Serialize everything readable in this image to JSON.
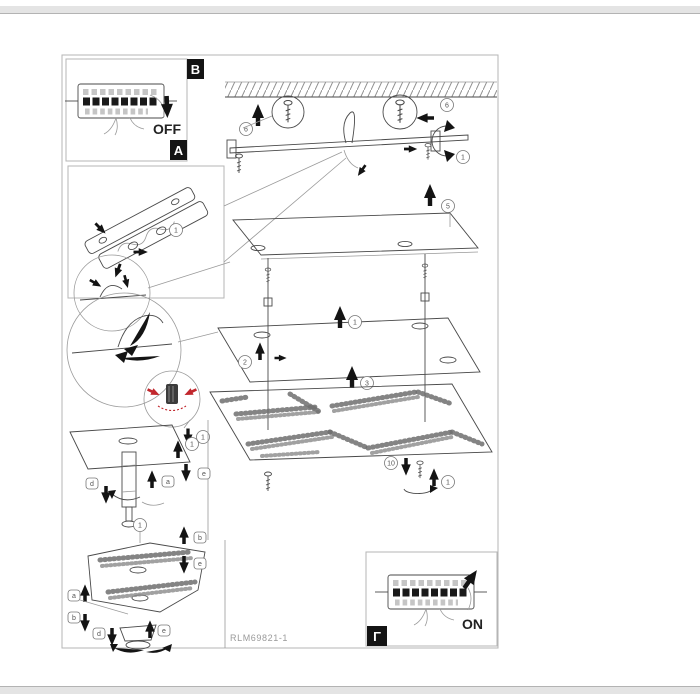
{
  "colors": {
    "accent_red": "#c1272d",
    "line": "#4a4a4a",
    "badge_bg": "#141414"
  },
  "page": {
    "part_number": "RLM69821-1"
  },
  "badges": {
    "step_b": "B",
    "step_a": "A",
    "step_c": "Γ"
  },
  "switch_top": {
    "state": "OFF"
  },
  "switch_bottom": {
    "state": "ON"
  },
  "callouts": {
    "top_left": "6",
    "top_right": "6",
    "turn_right": "1",
    "canopy": "5",
    "bracket_box": "1",
    "plate_up": "1",
    "plate_side": "2",
    "plate_lower": "3",
    "cable_clamp": "1",
    "decor_screw": "10",
    "decor_turn": "1",
    "post_top": "1",
    "post_left": "d",
    "post_mid": "a",
    "post_right": "e",
    "fixture_top": "1",
    "fixture_right_up": "b",
    "fixture_right_down": "e",
    "fixture_left_up": "a",
    "fixture_left_down": "b",
    "fixture_base_left": "d",
    "fixture_base_right": "e"
  }
}
